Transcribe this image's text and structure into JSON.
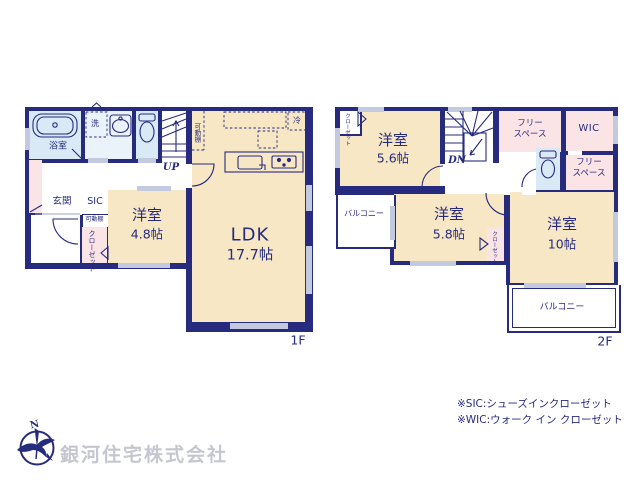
{
  "f1": {
    "floor": "1F",
    "bath": "浴室",
    "wash": "洗",
    "shelf_vertical": "可動棚",
    "up": "UP",
    "genkan": "玄関",
    "sic": "SIC",
    "shelf_small": "可動棚",
    "closet_col1": "クロー",
    "closet_col2": "ゼット",
    "room48_name": "洋室",
    "room48_size": "4.8帖",
    "ldk_name": "LDK",
    "ldk_size": "17.7帖",
    "fridge": "冷"
  },
  "f2": {
    "floor": "2F",
    "dn": "DN",
    "closet_col1": "クロー",
    "closet_col2": "ゼット",
    "room56_name": "洋室",
    "room56_size": "5.6帖",
    "room58_name": "洋室",
    "room58_size": "5.8帖",
    "closet58_col1": "クロー",
    "closet58_col2": "ゼット",
    "room10_name": "洋室",
    "room10_size": "10帖",
    "freespace_top_line1": "フリー",
    "freespace_top_line2": "スペース",
    "freespace_right_line1": "フリー",
    "freespace_right_line2": "スペース",
    "wic": "WIC",
    "balcony_left": "バルコニー",
    "balcony_right": "バルコニー"
  },
  "legend": {
    "sic": "※SIC:シューズインクローゼット",
    "wic": "※WIC:ウォーク イン クローゼット"
  },
  "company": {
    "name": "銀河住宅株式会社"
  },
  "colors": {
    "wall": "#272b7d",
    "room_cream": "#f7e7c5",
    "room_pink": "#fae4e6",
    "room_blue": "#d9e9f6",
    "window_gray": "#c3c9de",
    "company_text": "#c6c6d1"
  }
}
